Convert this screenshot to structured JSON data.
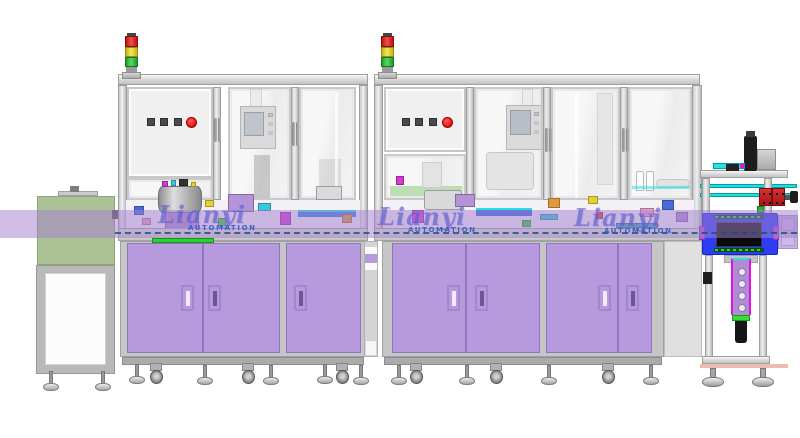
{
  "scene": {
    "description": "Side-elevation CAD rendering of a two-module automated assembly line with infeed conveyor stand and outfeed inspection station",
    "background": "#ffffff"
  },
  "watermark": {
    "name": "Lianyi",
    "subtitle": "AUTOMATION",
    "occurrences": 3
  },
  "palette": {
    "band_purple": "#a380d0",
    "cabinet_door_purple": "#b79ade",
    "frame_gray": "#dcdcdc",
    "infeed_green": "#a8bf93",
    "signal_red": "#d92020",
    "signal_yellow": "#eedd2e",
    "signal_green": "#3ecb44",
    "emergency_button_red": "#e01010",
    "inspection_box_blue": "#2f3df2",
    "rail_cyan": "#17e0e0",
    "belt_green": "#2ed12e",
    "gripper_purple": "#b08cd4",
    "gripper_magenta": "#e014e0"
  },
  "stations": {
    "infeed_stand": {
      "type": "conveyor stand",
      "top_color": "infeed_green"
    },
    "machine_1": {
      "signal_tower_lights": [
        "red",
        "yellow",
        "green"
      ],
      "panel_square_buttons": 3,
      "emergency_stops": 1,
      "door_handles": 3,
      "bays": 3
    },
    "machine_2": {
      "signal_tower_lights": [
        "red",
        "yellow",
        "green"
      ],
      "panel_square_buttons": 3,
      "emergency_stops": 1,
      "door_handles": 4,
      "bays": 4
    },
    "outfeed_station": {
      "type": "open frame inspection unit",
      "features": [
        "top motor",
        "cyan transfer rails",
        "red bearing blocks",
        "blue inspection box",
        "gripper arm",
        "suction cylinder"
      ]
    }
  }
}
